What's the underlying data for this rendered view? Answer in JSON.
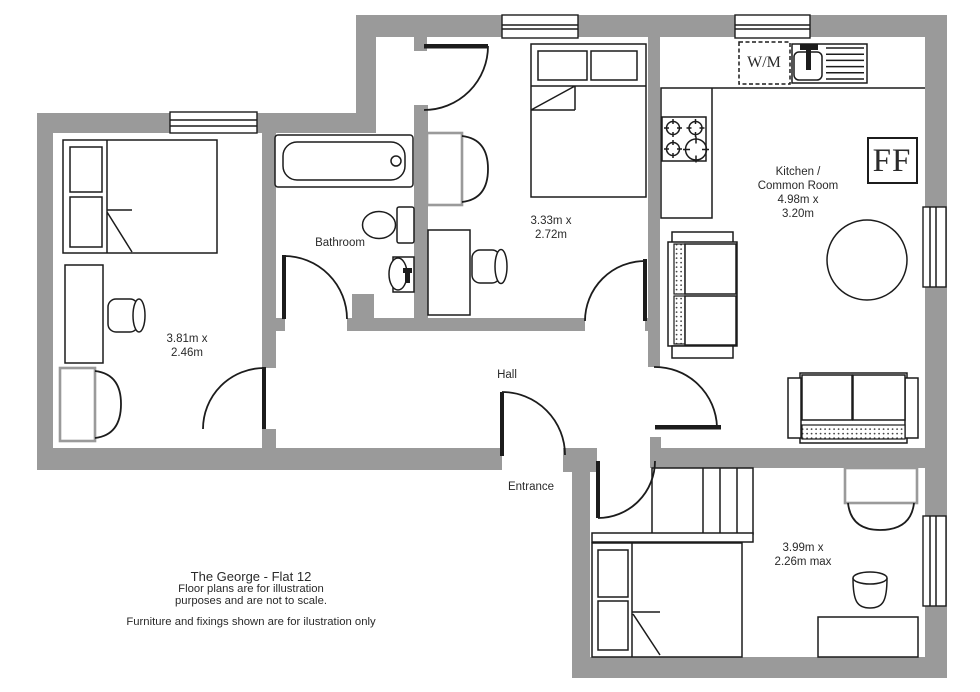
{
  "plan": {
    "rooms": {
      "bedroom1": {
        "dims_line1": "3.81m x",
        "dims_line2": "2.46m"
      },
      "bedroom2": {
        "dims_line1": "3.33m x",
        "dims_line2": "2.72m"
      },
      "bedroom3": {
        "dims_line1": "3.99m x",
        "dims_line2": "2.26m max"
      },
      "kitchen": {
        "name_line1": "Kitchen /",
        "name_line2": "Common Room",
        "dims_line1": "4.98m x",
        "dims_line2": "3.20m"
      },
      "bathroom": {
        "name": "Bathroom"
      },
      "hall": {
        "name": "Hall"
      },
      "entrance": {
        "name": "Entrance"
      }
    },
    "fixtures": {
      "washing_machine": "W/M",
      "floor_code": "FF"
    },
    "footer": {
      "title": "The George - Flat 12",
      "line1": "Floor plans are for illustration",
      "line2": "purposes and are not to scale.",
      "line3": "Furniture and fixings shown are for ilustration only"
    },
    "colors": {
      "wall": "#9a9a9a",
      "line": "#1c1c1c",
      "text": "#2a2a2a",
      "background": "#ffffff"
    }
  }
}
